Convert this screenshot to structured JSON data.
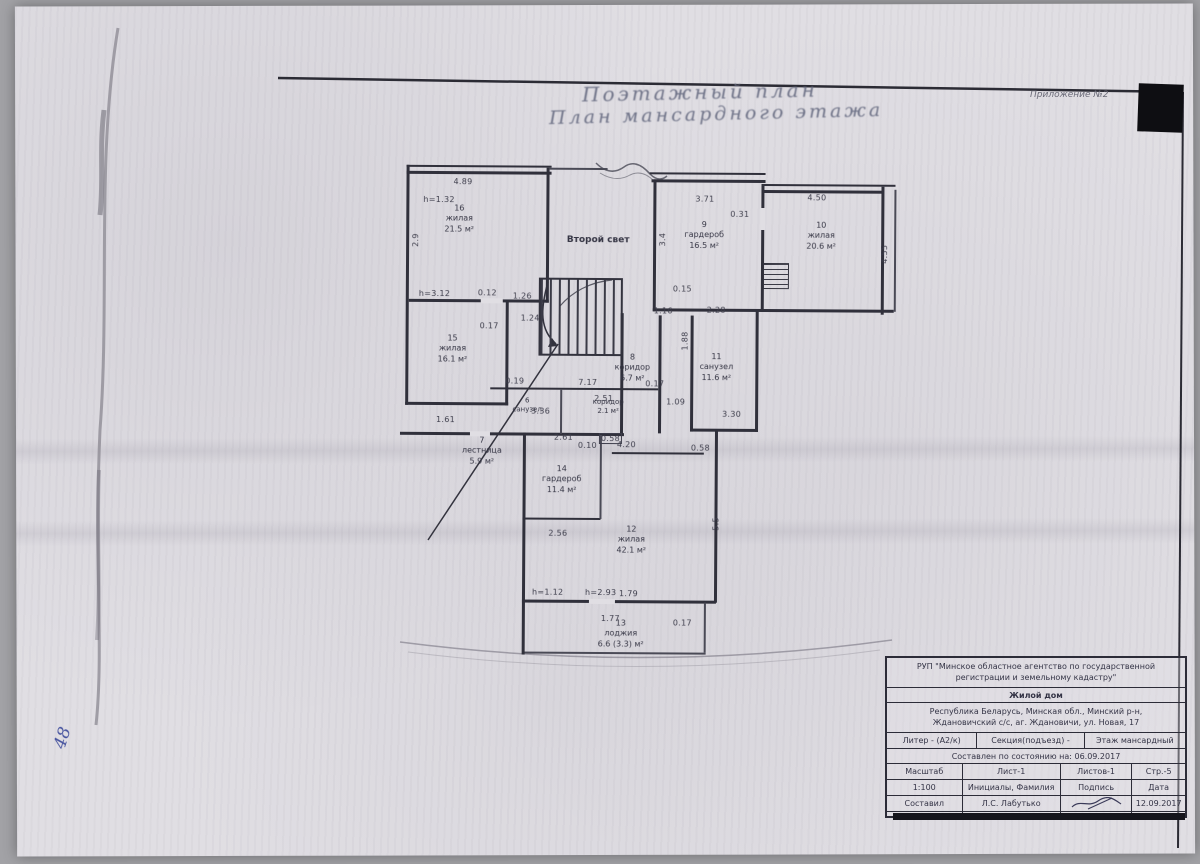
{
  "header": {
    "appendix": "Приложение №2",
    "title_line1": "Поэтажный план",
    "title_line2": "План мансардного этажа"
  },
  "margin": {
    "page_number": "48"
  },
  "plan": {
    "rooms": [
      {
        "num": "16",
        "name": "жилая",
        "area": "21.5 м²"
      },
      {
        "num": "",
        "name": "Второй свет",
        "area": ""
      },
      {
        "num": "9",
        "name": "гардероб",
        "area": "16.5 м²"
      },
      {
        "num": "10",
        "name": "жилая",
        "area": "20.6 м²"
      },
      {
        "num": "15",
        "name": "жилая",
        "area": "16.1 м²"
      },
      {
        "num": "8",
        "name": "коридор",
        "area": "6.7 м²"
      },
      {
        "num": "11",
        "name": "санузел",
        "area": "11.6 м²"
      },
      {
        "num": "6",
        "name": "санузел",
        "area": "3.4 м²"
      },
      {
        "num": "5",
        "name": "коридор",
        "area": "2.1 м²"
      },
      {
        "num": "7",
        "name": "лестница",
        "area": "5.9 м²"
      },
      {
        "num": "14",
        "name": "гардероб",
        "area": "11.4 м²"
      },
      {
        "num": "12",
        "name": "жилая",
        "area": "42.1 м²"
      },
      {
        "num": "13",
        "name": "лоджия",
        "area": "6.6 (3.3) м²"
      }
    ],
    "dims": [
      "4.89",
      "h=1.32",
      "2.9",
      "h=3.12",
      "0.12",
      "1.26",
      "1.24",
      "0.17",
      "3.71",
      "0.31",
      "4.50",
      "3.4",
      "4.55",
      "0.15",
      "1.16",
      "2.28",
      "1.88",
      "0.19",
      "7.17",
      "0.17",
      "2.51",
      "1.09",
      "3.36",
      "3.30",
      "1.61",
      "0.58",
      "4.20",
      "0.58",
      "2.61",
      "0.10",
      "2.56",
      "h=1.12",
      "h=2.93",
      "1.79",
      "1.77",
      "0.17",
      "5.5"
    ]
  },
  "title_block": {
    "org_line1": "РУП \"Минское областное агентство по государственной",
    "org_line2": "регистрации и земельному кадастру\"",
    "object_type": "Жилой дом",
    "address_line1": "Республика Беларусь, Минская обл., Минский р-н,",
    "address_line2": "Ждановичский с/с, аг. Ждановичи, ул. Новая, 17",
    "liter": "Литер - (А2/к)",
    "section": "Секция(подъезд)    -",
    "floor": "Этаж   мансардный",
    "date_note": "Составлен по состоянию на: 06.09.2017",
    "scale_label": "Масштаб",
    "sheet": "Лист-1",
    "sheets": "Листов-1",
    "page": "Стр.-5",
    "scale_value": "1:100",
    "name_header": "Инициалы, Фамилия",
    "sign_header": "Подпись",
    "date_header": "Дата",
    "rows": [
      {
        "role": "Составил",
        "name": "Л.С. Лабутько",
        "date": "12.09.2017"
      },
      {
        "role": "Изготовил",
        "name": "Л.С. Лабутько",
        "date": "09.01.2018"
      },
      {
        "role": "Проверила",
        "name": "Т.А. Михалевич",
        "date": ""
      }
    ]
  }
}
